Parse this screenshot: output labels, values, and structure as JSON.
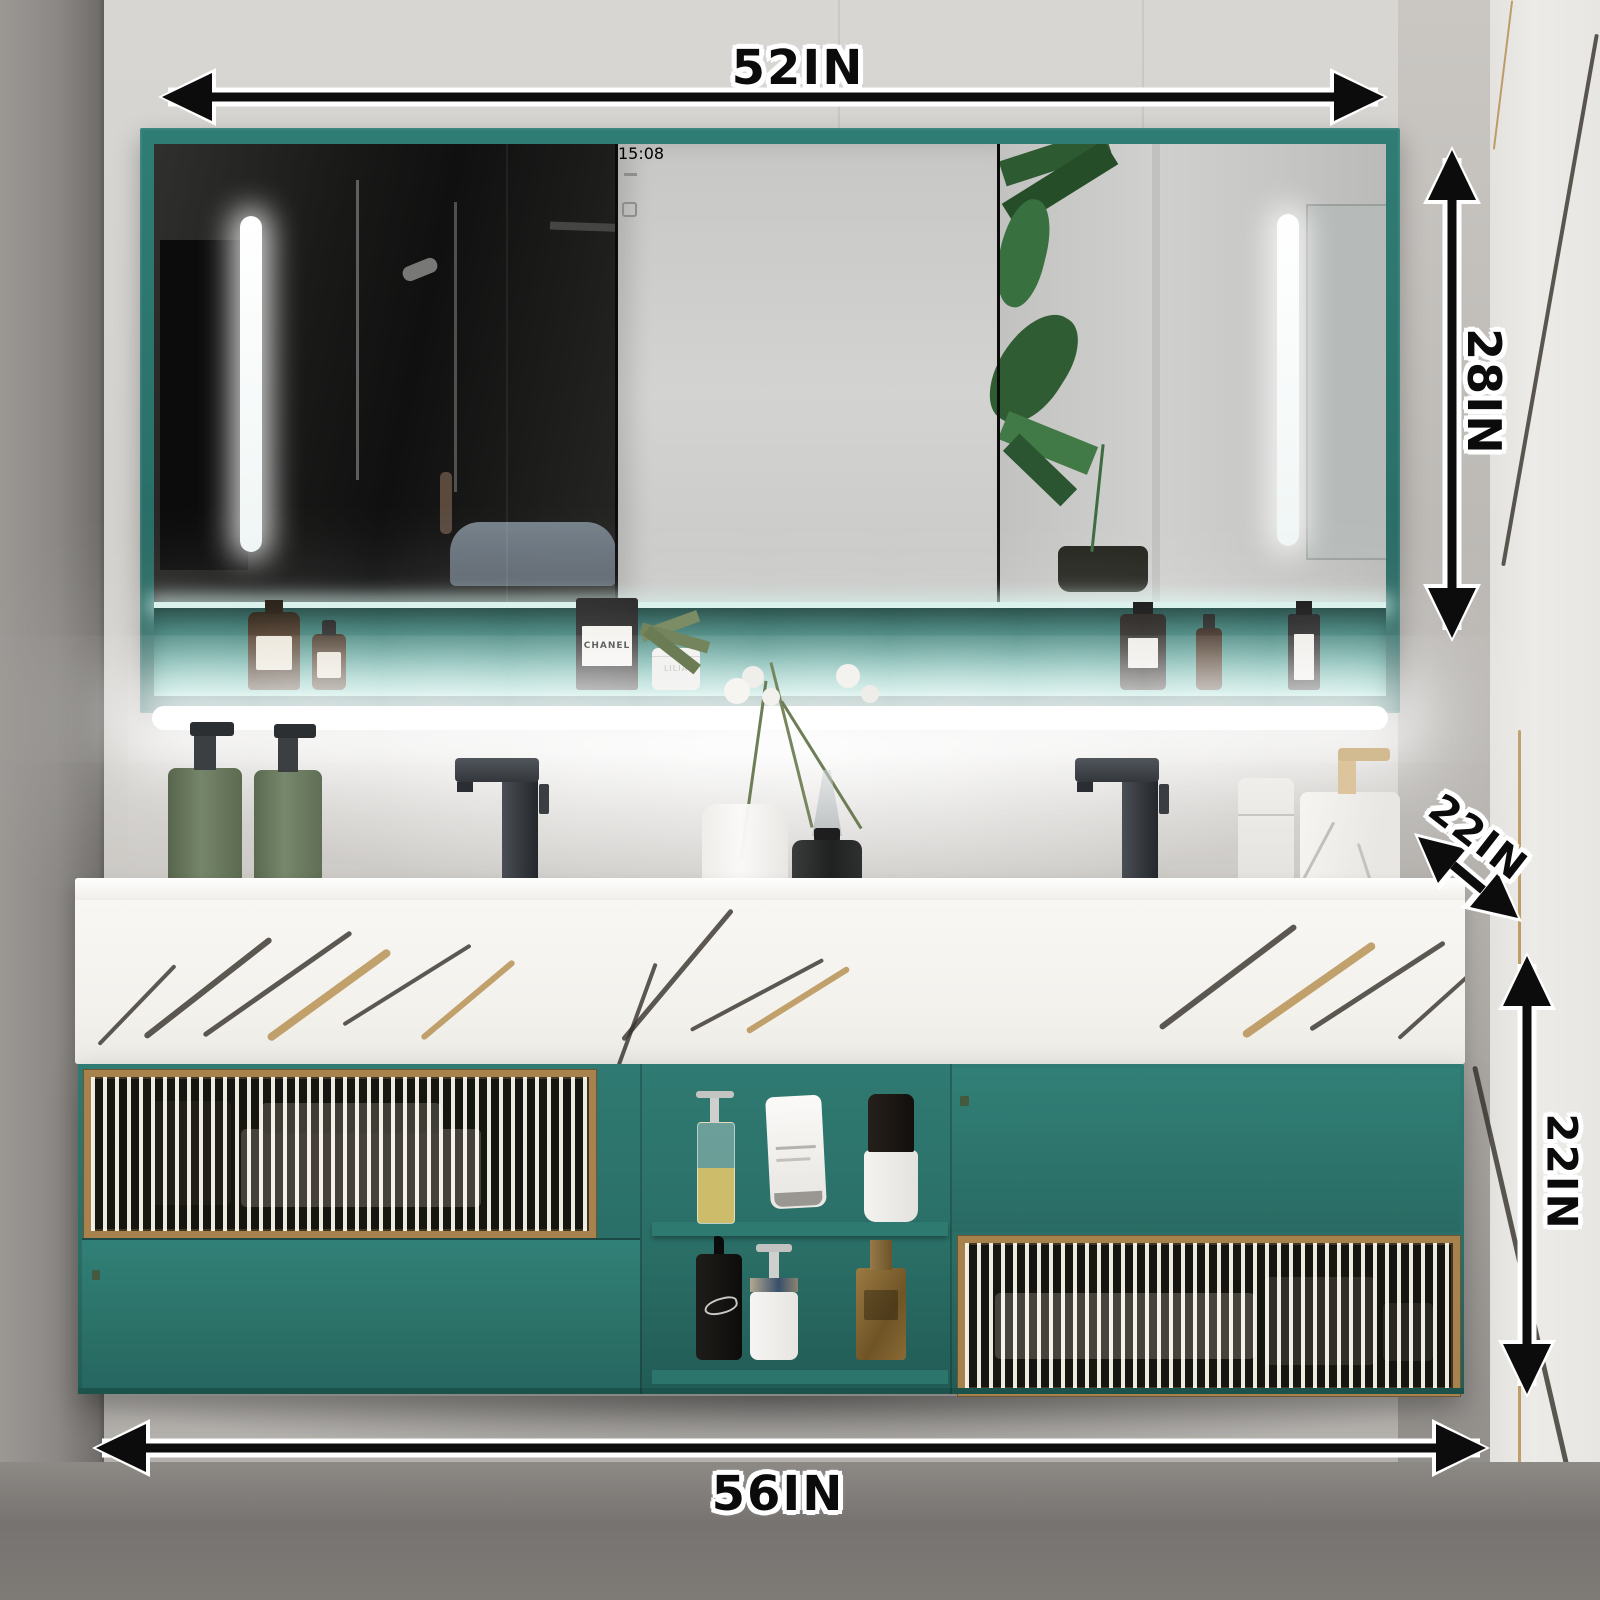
{
  "annotations": {
    "mirror_width": "52IN",
    "mirror_height": "28IN",
    "counter_depth": "22IN",
    "cabinet_height": "22IN",
    "vanity_width": "56IN"
  },
  "mirror_cabinet": {
    "clock_time": "15:08",
    "touch_buttons": [
      {
        "icon": "defogger-icon"
      },
      {
        "icon": "light-control-icon"
      }
    ]
  },
  "products": {
    "perfume_box_label": "CHANEL",
    "cream_jar_label": "LILIA"
  },
  "colors": {
    "cabinet_teal": "#2b756c",
    "frame_gold": "#a8824c",
    "marble_white": "#f7f5f1",
    "annotation_black": "#0b0b0b",
    "annotation_outline": "#ffffff",
    "led_white": "#ffffff"
  }
}
